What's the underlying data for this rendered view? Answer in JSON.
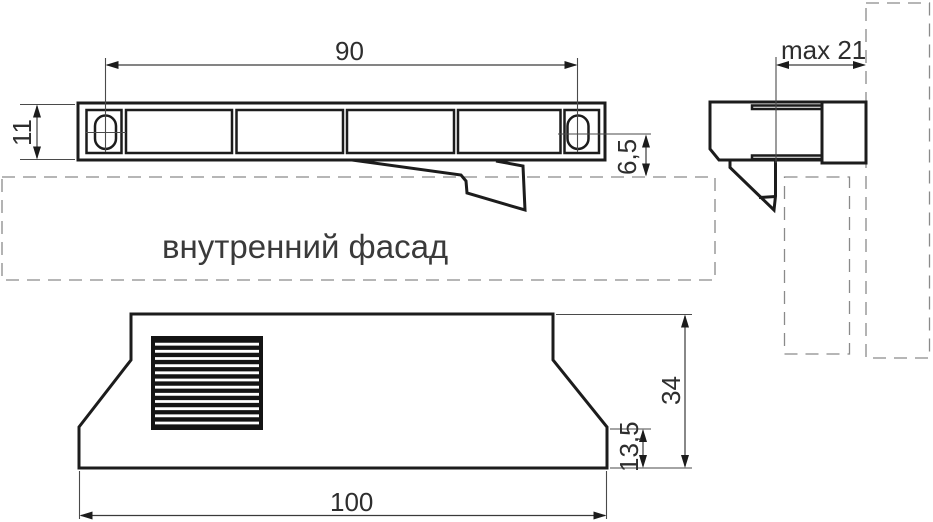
{
  "drawing": {
    "type": "technical-drawing-vent-grille",
    "colors": {
      "background": "#ffffff",
      "part_line": "#1c1c1c",
      "dimension_line": "#3a3a3a",
      "dashed_panel": "#8a8a8a",
      "text": "#2e2e2e"
    },
    "top_view": {
      "dim_slot_spacing": "90",
      "dim_height": "11",
      "dim_offset_to_facade": "6,5"
    },
    "side_view": {
      "dim_max_depth": "max 21"
    },
    "front_view": {
      "dim_total_height": "34",
      "dim_foot_height": "13,5",
      "dim_width": "100"
    },
    "labels": {
      "internal_facade": "внутренний фасад"
    }
  }
}
